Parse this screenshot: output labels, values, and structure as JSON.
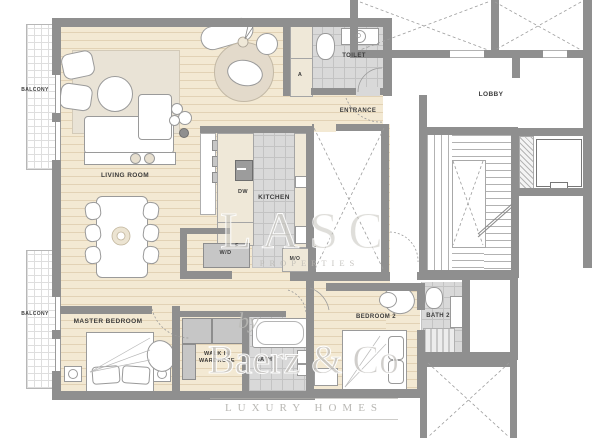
{
  "labels": {
    "balcony_top": "BALCONY",
    "balcony_bottom": "BALCONY",
    "living_room": "LIVING ROOM",
    "kitchen": "KITCHEN",
    "dw": "DW",
    "fridge": "F",
    "toilet": "TOILET",
    "cabinet_a": "A",
    "entrance": "ENTRANCE",
    "lobby": "LOBBY",
    "washer_dryer": "W/D",
    "micro": "M/O",
    "master_bedroom": "MASTER BEDROOM",
    "walk_in_line1": "WALK IN",
    "walk_in_line2": "WARDROBE",
    "bath": "BATH",
    "bedroom_2": "BEDROOM 2",
    "bath_2": "BATH 2"
  },
  "watermark": {
    "big": "LASC",
    "sub": "PROPERTIES",
    "by": "by",
    "brand": "Baerz & Co",
    "tagline": "LUXURY HOMES"
  },
  "colors": {
    "wall": "#8f8f8f",
    "wood_floor": "#f3e9d3",
    "tile_floor": "#d9d9d9",
    "cabinet": "#efe8d8",
    "label_text": "#3c3c3c",
    "watermark": "#c4c2bc"
  }
}
